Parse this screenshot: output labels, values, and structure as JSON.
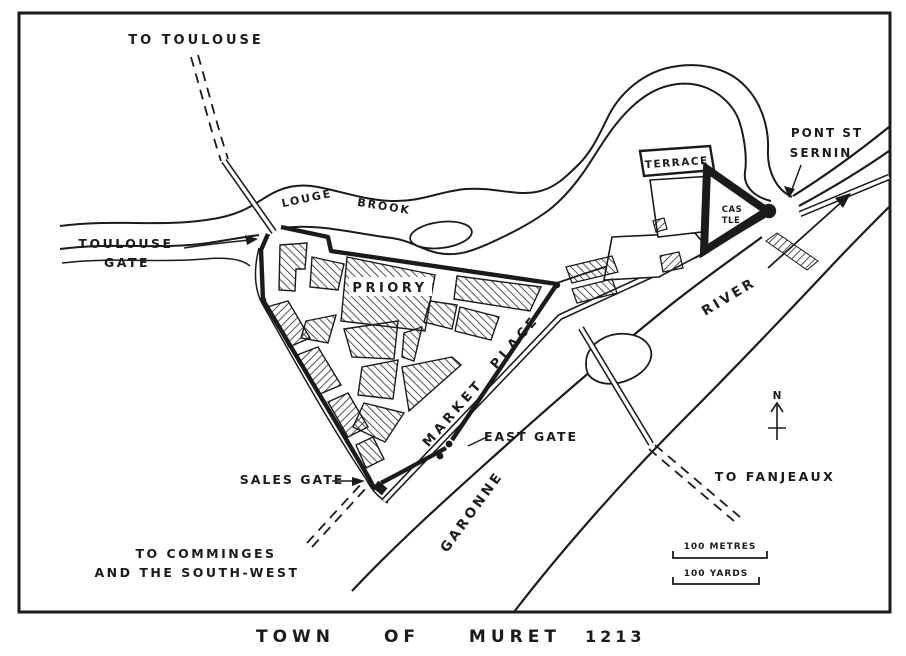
{
  "map": {
    "title": {
      "text": "TOWN OF MURET",
      "year": "1213"
    },
    "labels": {
      "to_toulouse": "TO TOULOUSE",
      "louge_word1": "LOUGE",
      "louge_word2": "BROOK",
      "toulouse_gate_line1": "TOULOUSE",
      "toulouse_gate_line2": "GATE",
      "priory": "PRIORY",
      "market_place": "MARKET PLACE",
      "terrace": "TERRACE",
      "castle_line1": "CAS",
      "castle_line2": "TLE",
      "pont_line1": "PONT ST",
      "pont_line2": "SERNIN",
      "river": "RIVER",
      "garonne": "GARONNE",
      "east_gate": "EAST GATE",
      "sales_gate": "SALES GATE",
      "to_fanjeaux": "TO FANJEAUX",
      "to_comminges_line1": "TO COMMINGES",
      "to_comminges_line2": "AND THE SOUTH-WEST",
      "north": "N",
      "scale_metres": "100 METRES",
      "scale_yards": "100 YARDS"
    },
    "colors": {
      "ink": "#1b1b1b",
      "paper": "#ffffff"
    }
  }
}
